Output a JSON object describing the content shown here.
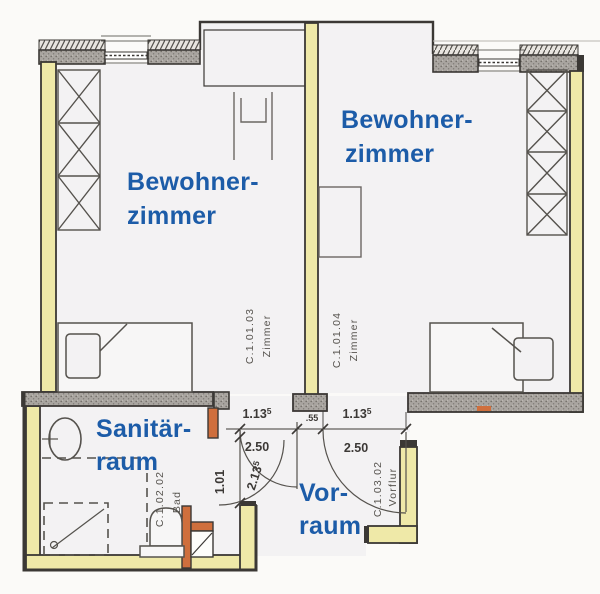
{
  "plan": {
    "rooms": {
      "bedroom_left": {
        "label_line1": "Bewohner-",
        "label_line2": "zimmer",
        "code": "C.1.01.03",
        "code_type": "Zimmer"
      },
      "bedroom_right": {
        "label_line1": "Bewohner-",
        "label_line2": "zimmer",
        "code": "C.1.01.04",
        "code_type": "Zimmer"
      },
      "sanitary": {
        "label_line1": "Sanitär-",
        "label_line2": "raum",
        "code": "C.1.02.02",
        "code_type": "Bad"
      },
      "anteroom": {
        "label_line1": "Vor-",
        "label_line2": "raum"
      },
      "hall": {
        "code": "C.1.03.02",
        "code_type": "Vorflur"
      }
    },
    "dimensions": {
      "door_left": {
        "value": "1.13",
        "sup": "5"
      },
      "door_right": {
        "value": "1.13",
        "sup": "5"
      },
      "width_left": {
        "value": "2.50"
      },
      "width_right": {
        "value": "2.50"
      },
      "pillar": {
        "value": ".55"
      },
      "bath_door": {
        "value": "1.01"
      },
      "diagonal": {
        "value": "2.13",
        "sup": "5"
      }
    },
    "colors": {
      "wall_fill": "#efe9a8",
      "masonry": "#a9a5a0",
      "accent": "#cf6f3d",
      "label": "#1c5ca8",
      "code_text": "#57544f",
      "dim_text": "#3c3936",
      "line": "#3b3835",
      "floor": "#f3f2f3"
    }
  }
}
